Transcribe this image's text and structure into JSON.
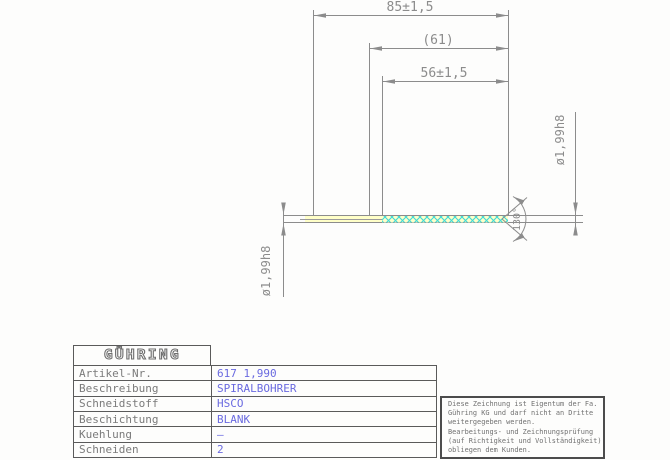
{
  "drawing": {
    "dims": {
      "overall_length": "85±1,5",
      "ref_length": "(61)",
      "flute_length": "56±1,5",
      "dia_left": "ø1,99h8",
      "dia_right": "ø1,99h8",
      "point_angle": "130°"
    },
    "colors": {
      "line": "#8c8c8c",
      "hatch_cyan": "#3cd9d9",
      "shank_yellow": "#ffffc8",
      "value_blue": "#6a6ae0"
    }
  },
  "title_block": {
    "logo": "GÜHRING",
    "rows": [
      {
        "label": "Artikel-Nr.",
        "value": "617 1,990"
      },
      {
        "label": "Beschreibung",
        "value": "SPIRALBOHRER"
      },
      {
        "label": "Schneidstoff",
        "value": "HSCO"
      },
      {
        "label": "Beschichtung",
        "value": "BLANK"
      },
      {
        "label": "Kuehlung",
        "value": "–"
      },
      {
        "label": "Schneiden",
        "value": "2"
      }
    ]
  },
  "note_box": {
    "lines": [
      "Diese Zeichnung ist Eigentum der Fa.",
      "Gühring KG und darf nicht an Dritte",
      "weitergegeben werden.",
      "Bearbeitungs- und Zeichnungsprüfung",
      "(auf Richtigkeit und Vollständigkeit)",
      "obliegen dem Kunden."
    ]
  }
}
